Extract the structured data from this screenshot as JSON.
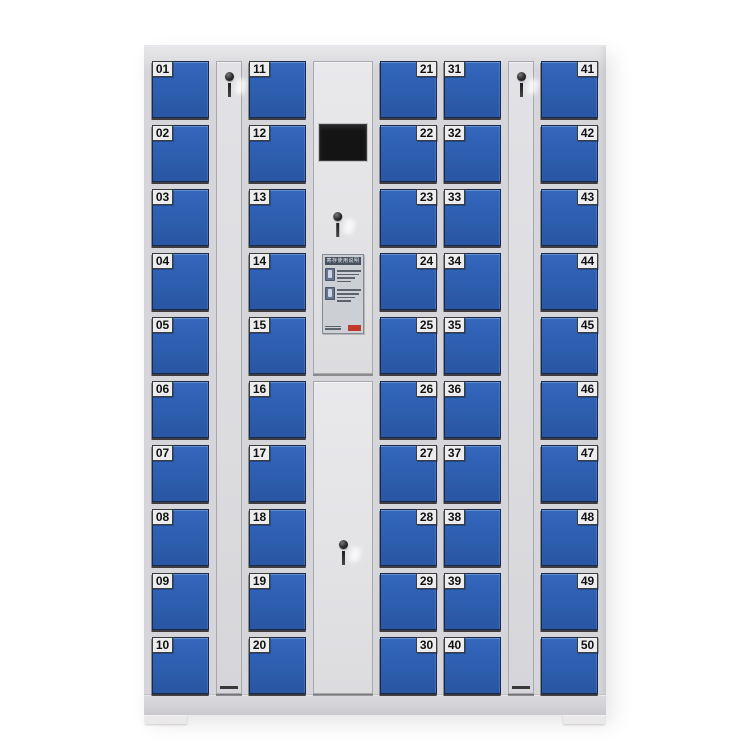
{
  "cabinet": {
    "colors": {
      "frame": "#d6d6da",
      "frame_light": "#e9e9ec",
      "door_blue": "#2f62b5",
      "door_blue_dark": "#2a56a2",
      "door_border": "#17294e",
      "label_bg": "#ededef",
      "label_text": "#111111",
      "panel_fill": "#dcdcdf",
      "panel_border": "#a8a8af",
      "control_fill": "#e3e3e6",
      "screen_black": "#141414",
      "sticker_bg": "#ccd0d5",
      "sticker_title_bg": "#46505f",
      "stamp_red": "#c0392b",
      "base_gray": "#d2d2d6",
      "feet_gray": "#eae8e9"
    },
    "sticker": {
      "title": "寄存使用说明"
    },
    "columns": [
      {
        "kind": "locker-column",
        "label_side": "left",
        "doors": [
          "01",
          "02",
          "03",
          "04",
          "05",
          "06",
          "07",
          "08",
          "09",
          "10"
        ]
      },
      {
        "kind": "key-panel",
        "icon": "key-icon"
      },
      {
        "kind": "locker-column",
        "label_side": "left",
        "doors": [
          "11",
          "12",
          "13",
          "14",
          "15",
          "16",
          "17",
          "18",
          "19",
          "20"
        ]
      },
      {
        "kind": "control-column",
        "parts": [
          "screen",
          "key-icon",
          "instruction-sticker",
          "lower-door",
          "key-icon"
        ]
      },
      {
        "kind": "locker-column",
        "label_side": "right",
        "doors": [
          "21",
          "22",
          "23",
          "24",
          "25",
          "26",
          "27",
          "28",
          "29",
          "30"
        ]
      },
      {
        "kind": "locker-column",
        "label_side": "left",
        "doors": [
          "31",
          "32",
          "33",
          "34",
          "35",
          "36",
          "37",
          "38",
          "39",
          "40"
        ]
      },
      {
        "kind": "key-panel",
        "icon": "key-icon"
      },
      {
        "kind": "locker-column",
        "label_side": "right",
        "doors": [
          "41",
          "42",
          "43",
          "44",
          "45",
          "46",
          "47",
          "48",
          "49",
          "50"
        ]
      }
    ]
  }
}
